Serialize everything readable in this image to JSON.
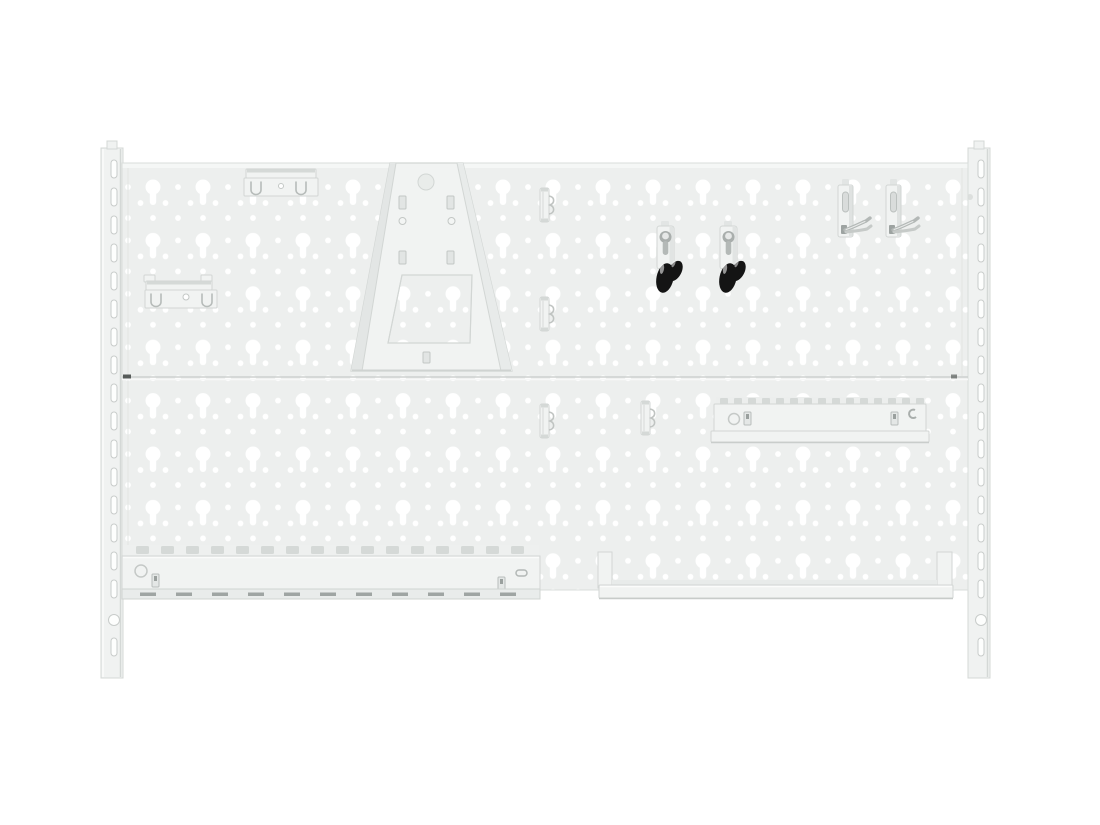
{
  "image": {
    "kind": "product-photo",
    "subject": "white-pegboard-wall-panel-with-accessories"
  },
  "colors": {
    "background": "#ffffff",
    "board": "#edefee",
    "board_top_fold": "#f5f7f6",
    "board_edge": "#d9dddb",
    "hole": "#ffffff",
    "seam": "#cdd1cf",
    "seam_tick": "#565b59",
    "rail": "#f0f2f1",
    "rail_edge": "#d4d8d6",
    "rail_slot": "#fdfefd",
    "rail_slot_edge": "#c8ccca",
    "accessory": "#f1f3f2",
    "accessory_edge": "#d2d6d4",
    "accessory_shade": "#e2e5e4",
    "metal_detail": "#b7bcba",
    "metal_dark": "#9da3a1",
    "hook_tip_black": "#141414",
    "hook_tip_gloss": "#ffffff",
    "tooth": "#d5d9d7",
    "slot_dark": "#9fa5a3"
  },
  "parts": [
    "wall-rail-left",
    "wall-rail-right",
    "pegboard-panel-top",
    "pegboard-panel-bottom",
    "spring-clip-holder-top",
    "spring-clip-holder-middle",
    "machine-holder-cone",
    "small-spring-clip-1",
    "small-spring-clip-2",
    "small-spring-clip-3",
    "small-spring-clip-4",
    "black-tip-hook-1",
    "black-tip-hook-2",
    "double-prong-hook-1",
    "double-prong-hook-2",
    "tool-holder-rail",
    "slotted-tool-rail",
    "bottom-shelf"
  ]
}
